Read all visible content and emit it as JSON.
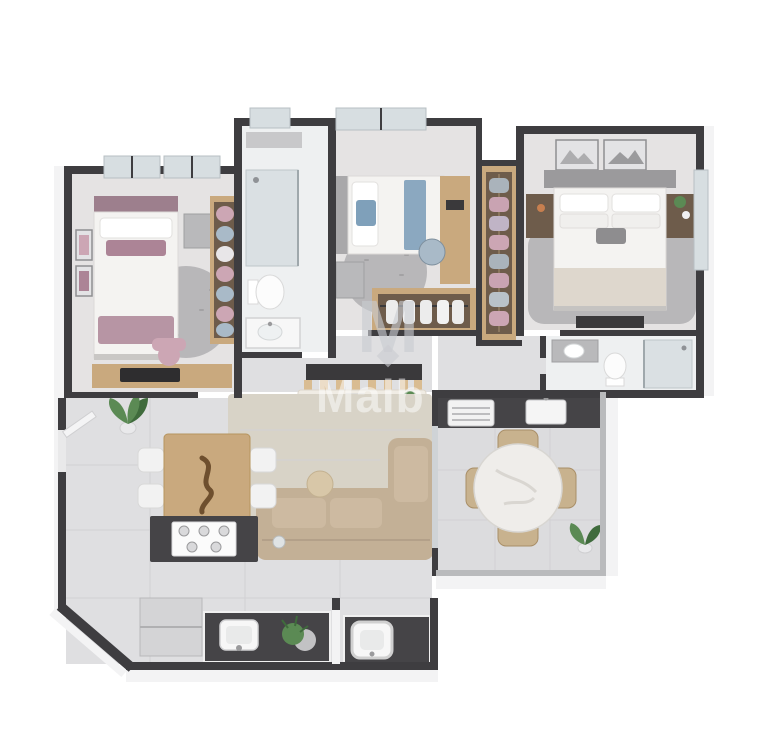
{
  "meta": {
    "description": "3D isometric rendered floor plan of a two/three-bedroom apartment, viewed from above, white background",
    "width_px": 758,
    "height_px": 753
  },
  "watermark": {
    "logo_letter": "M",
    "text": "Malb",
    "style": "semi-transparent overlay centered on plan"
  },
  "colors": {
    "bg": "#ffffff",
    "wall_dark": "#3e3d40",
    "wall_face": "#f3f3f4",
    "wall_railing": "#b9babc",
    "floor_main": "#dfdfe1",
    "floor_warm": "#e5e3e3",
    "floor_bath": "#eef0f1",
    "floor_balcony": "#dcdcde",
    "tile_line": "#d2d1d4",
    "counter_dark": "#454447",
    "wood": "#c9a97e",
    "wood_light": "#d9bc92",
    "wood_dark": "#6e5c4b",
    "gray_furniture": "#b9b9bb",
    "rug_gray": "#b8b7b9",
    "rug_beige": "#d8d3c7",
    "sofa_beige": "#c3b096",
    "sofa_cushion": "#cdbaa1",
    "bed_white": "#f4f3f1",
    "mauve": "#ac8496",
    "pink": "#cca6b4",
    "blue": "#7fa0ba",
    "blue_gray": "#a9bac8",
    "marble": "#efedea",
    "chair_beige": "#c8b28e",
    "plant_green": "#5b8a54",
    "plant_dark": "#3f6b3c",
    "glass": "#d7dee1",
    "glass_frame": "#b7bfc3",
    "fixture_white": "#f7f7f7",
    "watermark": "#ffffff",
    "logo_color": "#c9ccd1"
  },
  "scene": {
    "type": "apartment-floor-plan",
    "rooms": [
      {
        "name": "bedroom-1",
        "position": "top-left",
        "furniture": [
          "single bed with mauve accents",
          "gray nightstand",
          "round gray rug",
          "wardrobe with hanging clothes",
          "desk with laptop",
          "pink chair",
          "wall art",
          "two windows"
        ]
      },
      {
        "name": "bathroom-1",
        "position": "top-center-left",
        "furniture": [
          "walk-in glass shower",
          "toilet",
          "vanity sink",
          "small window"
        ]
      },
      {
        "name": "bedroom-2",
        "position": "top-center",
        "furniture": [
          "single bed with blue accents",
          "gray nightstand",
          "round gray rug",
          "wooden desk",
          "chair",
          "open wardrobe rail with white clothes",
          "window"
        ]
      },
      {
        "name": "walk-in-closet",
        "position": "center",
        "furniture": [
          "hanging clothes rail with pink and gray garments"
        ]
      },
      {
        "name": "master-bedroom",
        "position": "top-right",
        "furniture": [
          "double bed",
          "two dark wood nightstands",
          "two framed artworks",
          "gray shag rug",
          "tv console",
          "side window"
        ]
      },
      {
        "name": "ensuite-bathroom",
        "position": "right-middle",
        "furniture": [
          "vanity sink",
          "toilet",
          "glass shower"
        ]
      },
      {
        "name": "hallway",
        "position": "center",
        "furniture": [
          "dark tv panel",
          "slatted console table with book and plant"
        ]
      },
      {
        "name": "living-dining",
        "position": "center-left",
        "furniture": [
          "l-shaped beige sofa",
          "beige area rug",
          "round pillow",
          "wooden dining table",
          "four white chairs",
          "dark kitchen island with gas cooktop",
          "refrigerator",
          "potted plant",
          "entry door"
        ]
      },
      {
        "name": "kitchen-laundry-strip",
        "position": "bottom",
        "furniture": [
          "dark kitchen counter",
          "kitchen sink",
          "potted plant",
          "laundry counter",
          "square laundry tub"
        ]
      },
      {
        "name": "balcony",
        "position": "bottom-right",
        "furniture": [
          "dark counter with grill and sink",
          "round marble dining table",
          "four rattan chairs",
          "potted plant"
        ]
      }
    ]
  }
}
